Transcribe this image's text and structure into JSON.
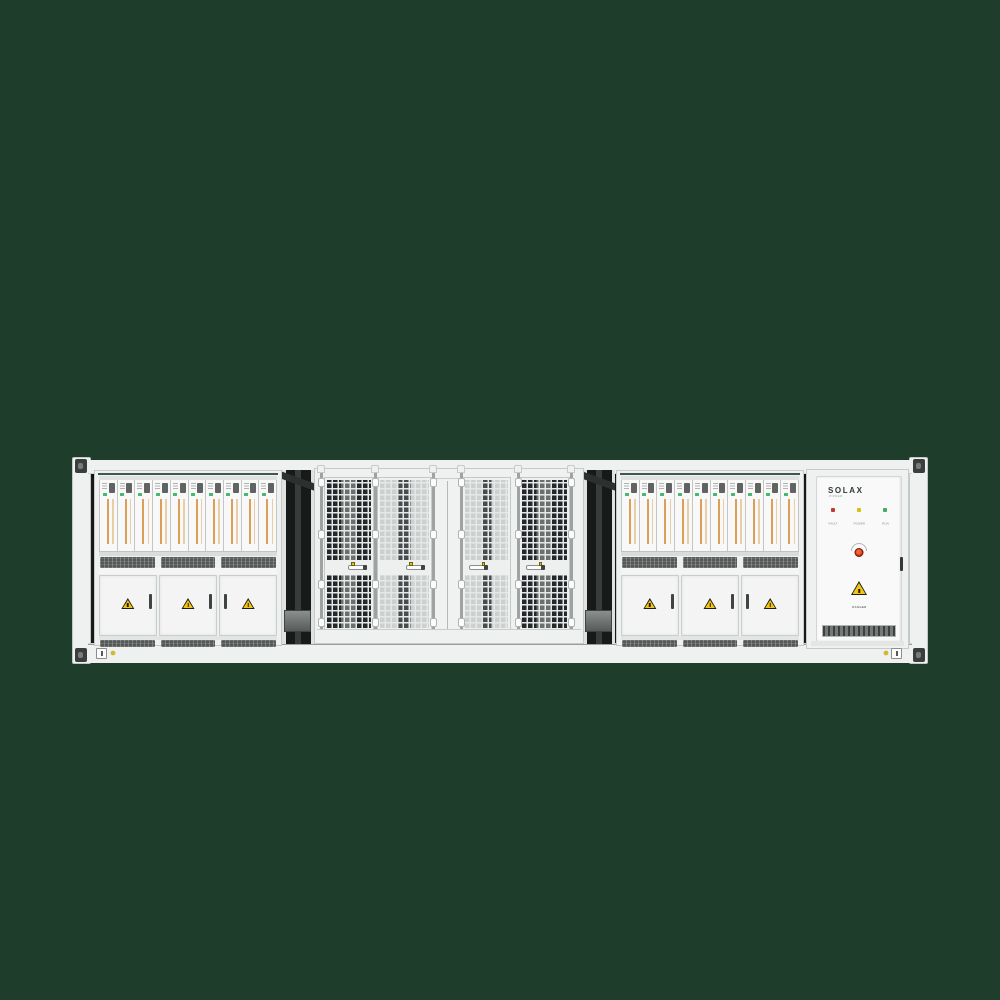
{
  "pcs_cabinets": [
    {
      "label": "PCS Distribution Cabinet",
      "module_count": 10,
      "door_count": 3,
      "vent_segments": 3
    },
    {
      "label": "PCS Distribution Cabinet",
      "module_count": 10,
      "door_count": 3,
      "vent_segments": 3
    }
  ],
  "mesh_bay": {
    "doors": [
      {
        "variant": "dark",
        "latch": "right"
      },
      {
        "variant": "light",
        "latch": "right"
      },
      {
        "variant": "light",
        "latch": "left"
      },
      {
        "variant": "dark",
        "latch": "left"
      }
    ]
  },
  "control_cabinet": {
    "brand": "SOLAX",
    "brand_sub": "POWER",
    "leds": [
      {
        "name": "fault",
        "label": "FAULT",
        "color": "#c0392b"
      },
      {
        "name": "power",
        "label": "POWER",
        "color": "#d4c116"
      },
      {
        "name": "run",
        "label": "RUN",
        "color": "#3fae62"
      }
    ],
    "warning_text": "DANGER"
  },
  "colors": {
    "background": "#1f3d2b",
    "shell": "#eff1f0",
    "shell_dark": "#dfe2e0",
    "frame_line": "#c6cac8",
    "interior_dark": "#161a18",
    "vent_dark": "#545957",
    "mesh_dark": "#24282b",
    "mesh_light_bg": "#ccd0ce",
    "mesh_line": "#e6e8e7",
    "module_face": "#f7f8f7",
    "module_stripe": "#dc9f57",
    "module_chip_green": "#45b86b",
    "module_display": "#5f6462",
    "warning_yellow": "#f2c511",
    "metal_gray": "#7b807e",
    "estop_red": "#d23415",
    "indicator_yellow_dot": "#d8b91c"
  }
}
